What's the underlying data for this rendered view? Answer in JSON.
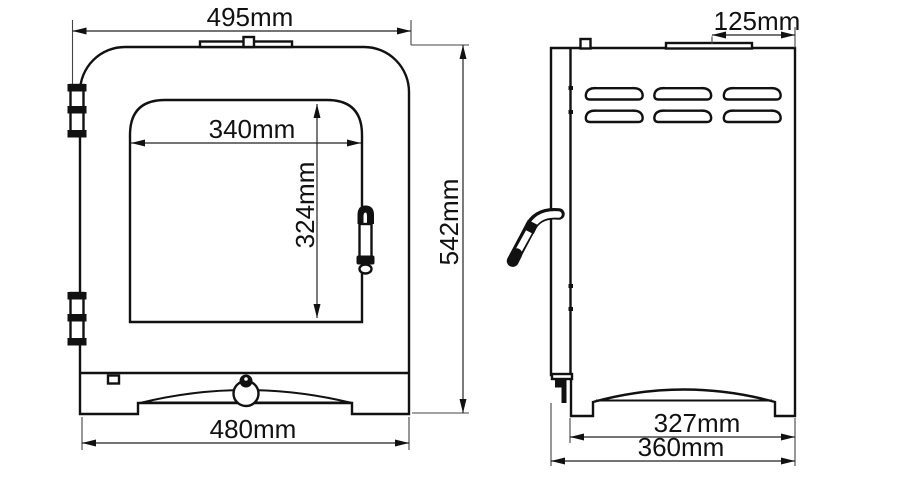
{
  "drawing": {
    "kind": "technical-dimension-drawing",
    "subject": "stove-front-and-side-elevation",
    "background": "#ffffff",
    "line_color": "#111111",
    "dimension_color": "#222222",
    "views": {
      "front": {
        "dimensions": {
          "overall_width": "495mm",
          "glass_width": "340mm",
          "glass_height": "324mm",
          "overall_height": "542mm",
          "base_width": "480mm"
        }
      },
      "side": {
        "dimensions": {
          "flue_centre_to_rear": "125mm",
          "body_depth": "327mm",
          "overall_depth": "360mm"
        }
      }
    }
  }
}
